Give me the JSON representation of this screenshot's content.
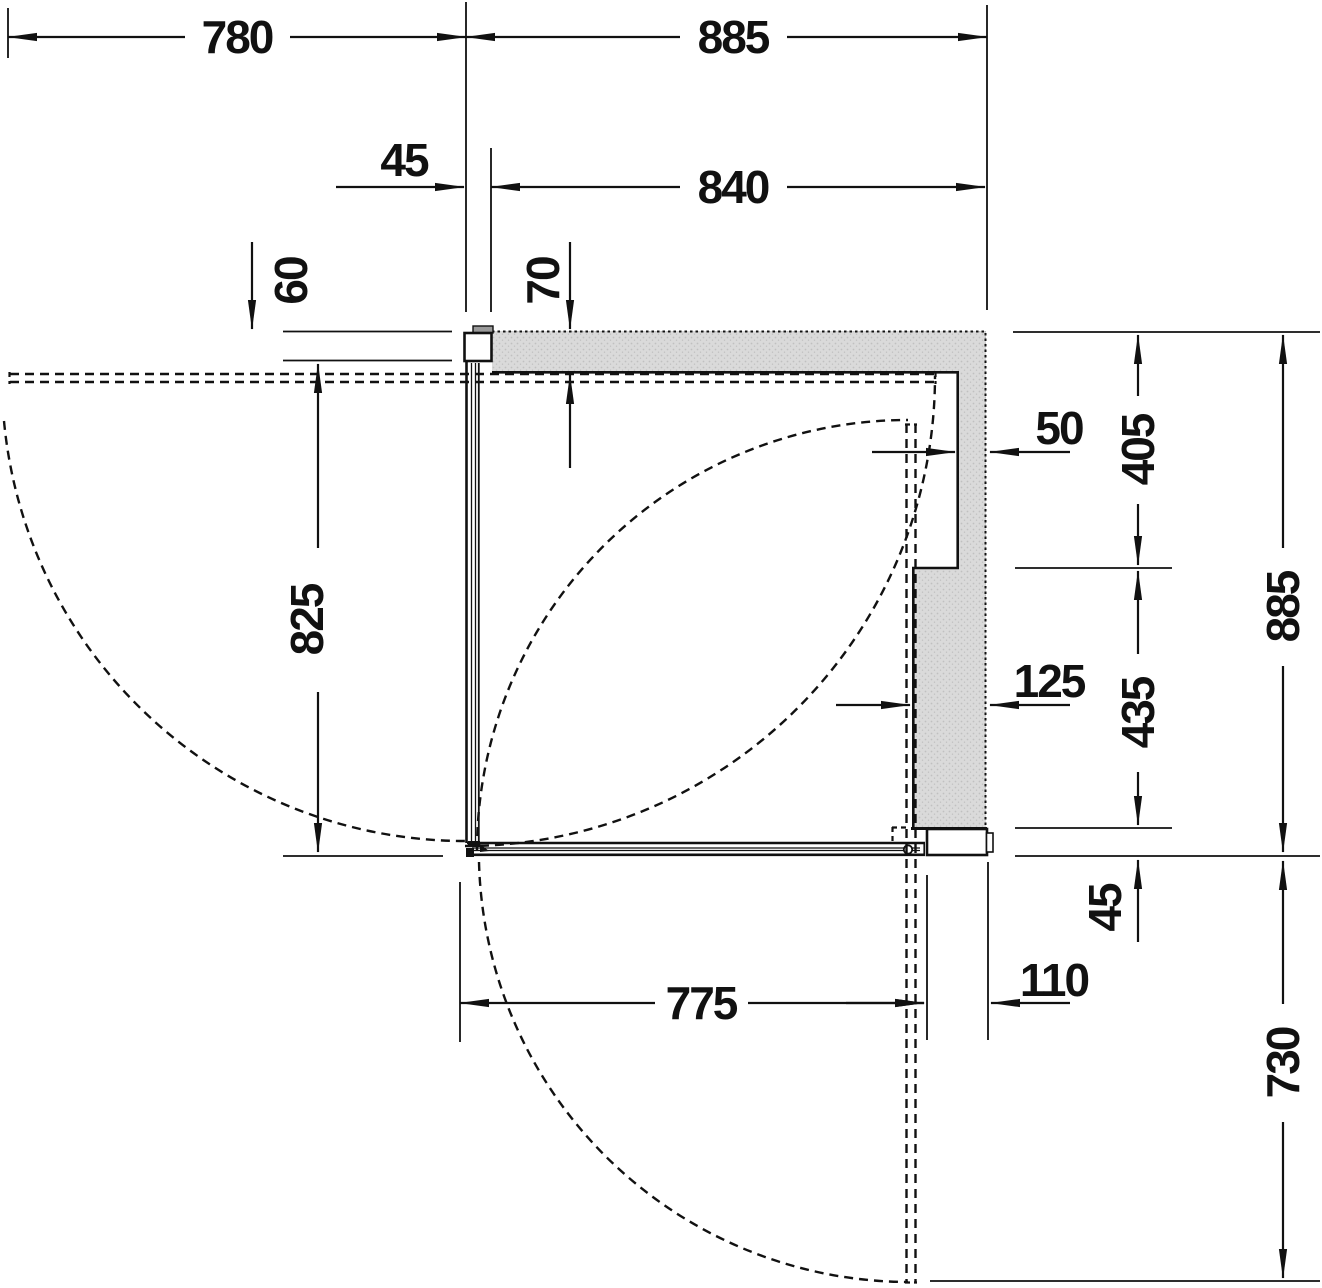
{
  "colors": {
    "background": "#ffffff",
    "line": "#111111",
    "wall_fill": "#dadada",
    "wall_speckle": "#c0c0c0",
    "profile_tab": "#9a9a9a",
    "profile_fill": "#ffffff"
  },
  "dims": {
    "swing_left_projection": "780",
    "overall_width": "885",
    "niche_offset": "45",
    "entry_width": "840",
    "profile_depth": "60",
    "top_wall_thickness": "70",
    "upper_wall_thickness": "50",
    "upper_wall_length": "405",
    "overall_depth": "885",
    "lower_wall_thickness": "125",
    "lower_wall_length": "435",
    "side_panel_length": "825",
    "bottom_gap": "45",
    "door_offset_bottom": "110",
    "swing_bottom_projection": "730",
    "entry_depth": "775"
  }
}
